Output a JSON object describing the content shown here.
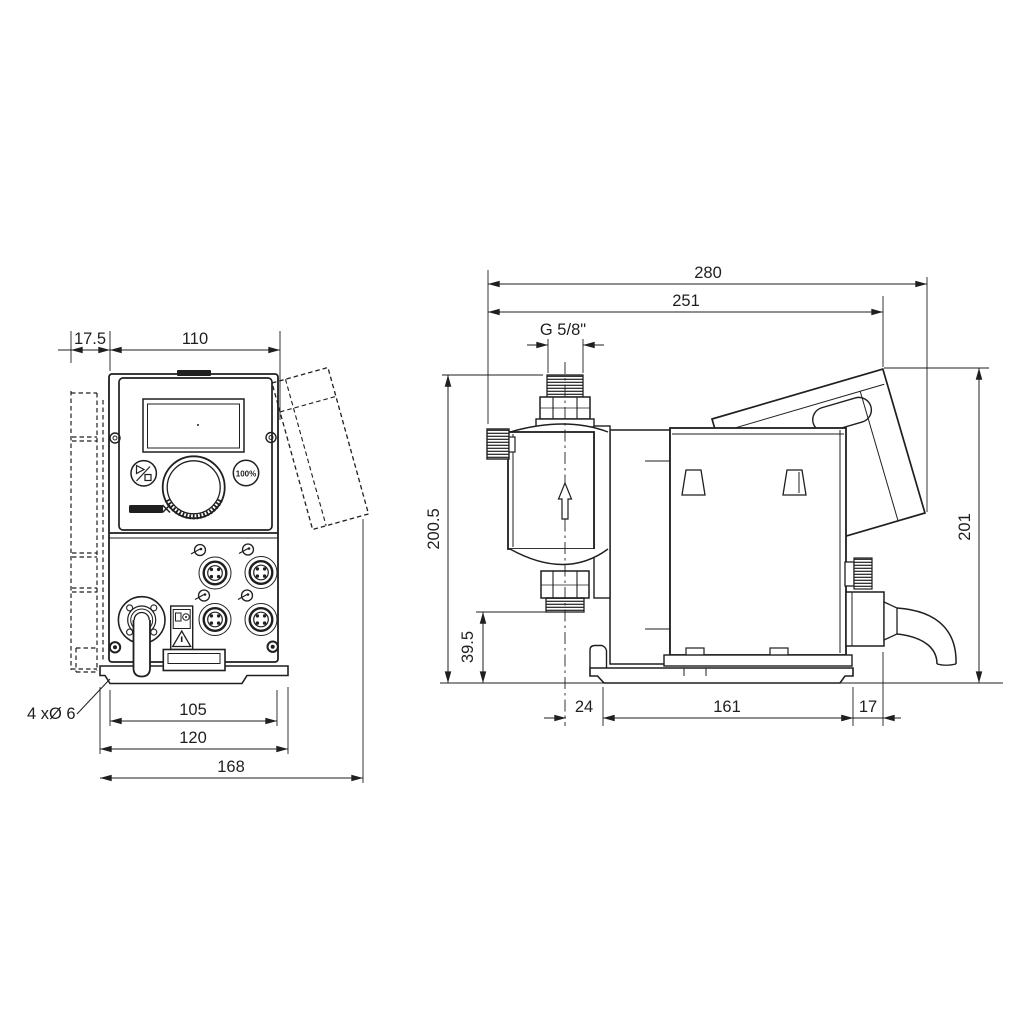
{
  "meta": {
    "line_color": "#1f1f1f",
    "background_color": "#ffffff"
  },
  "front_view": {
    "dim_bracket_offset": "17.5",
    "dim_body_width": "110",
    "mounting_holes_label": "4 xØ 6",
    "dim_hole_spacing": "105",
    "dim_plate_width": "120",
    "dim_overall_width": "168",
    "control_panel": {
      "boost_button_label": "100%"
    }
  },
  "side_view": {
    "dim_overall_depth": "280",
    "dim_body_depth": "251",
    "thread_label": "G 5/8\"",
    "dim_height_to_valve_top": "200.5",
    "dim_valve_bottom_height": "39.5",
    "dim_head_to_plate": "24",
    "dim_plate_depth": "161",
    "dim_plate_to_rear": "17",
    "dim_overall_height": "201"
  }
}
